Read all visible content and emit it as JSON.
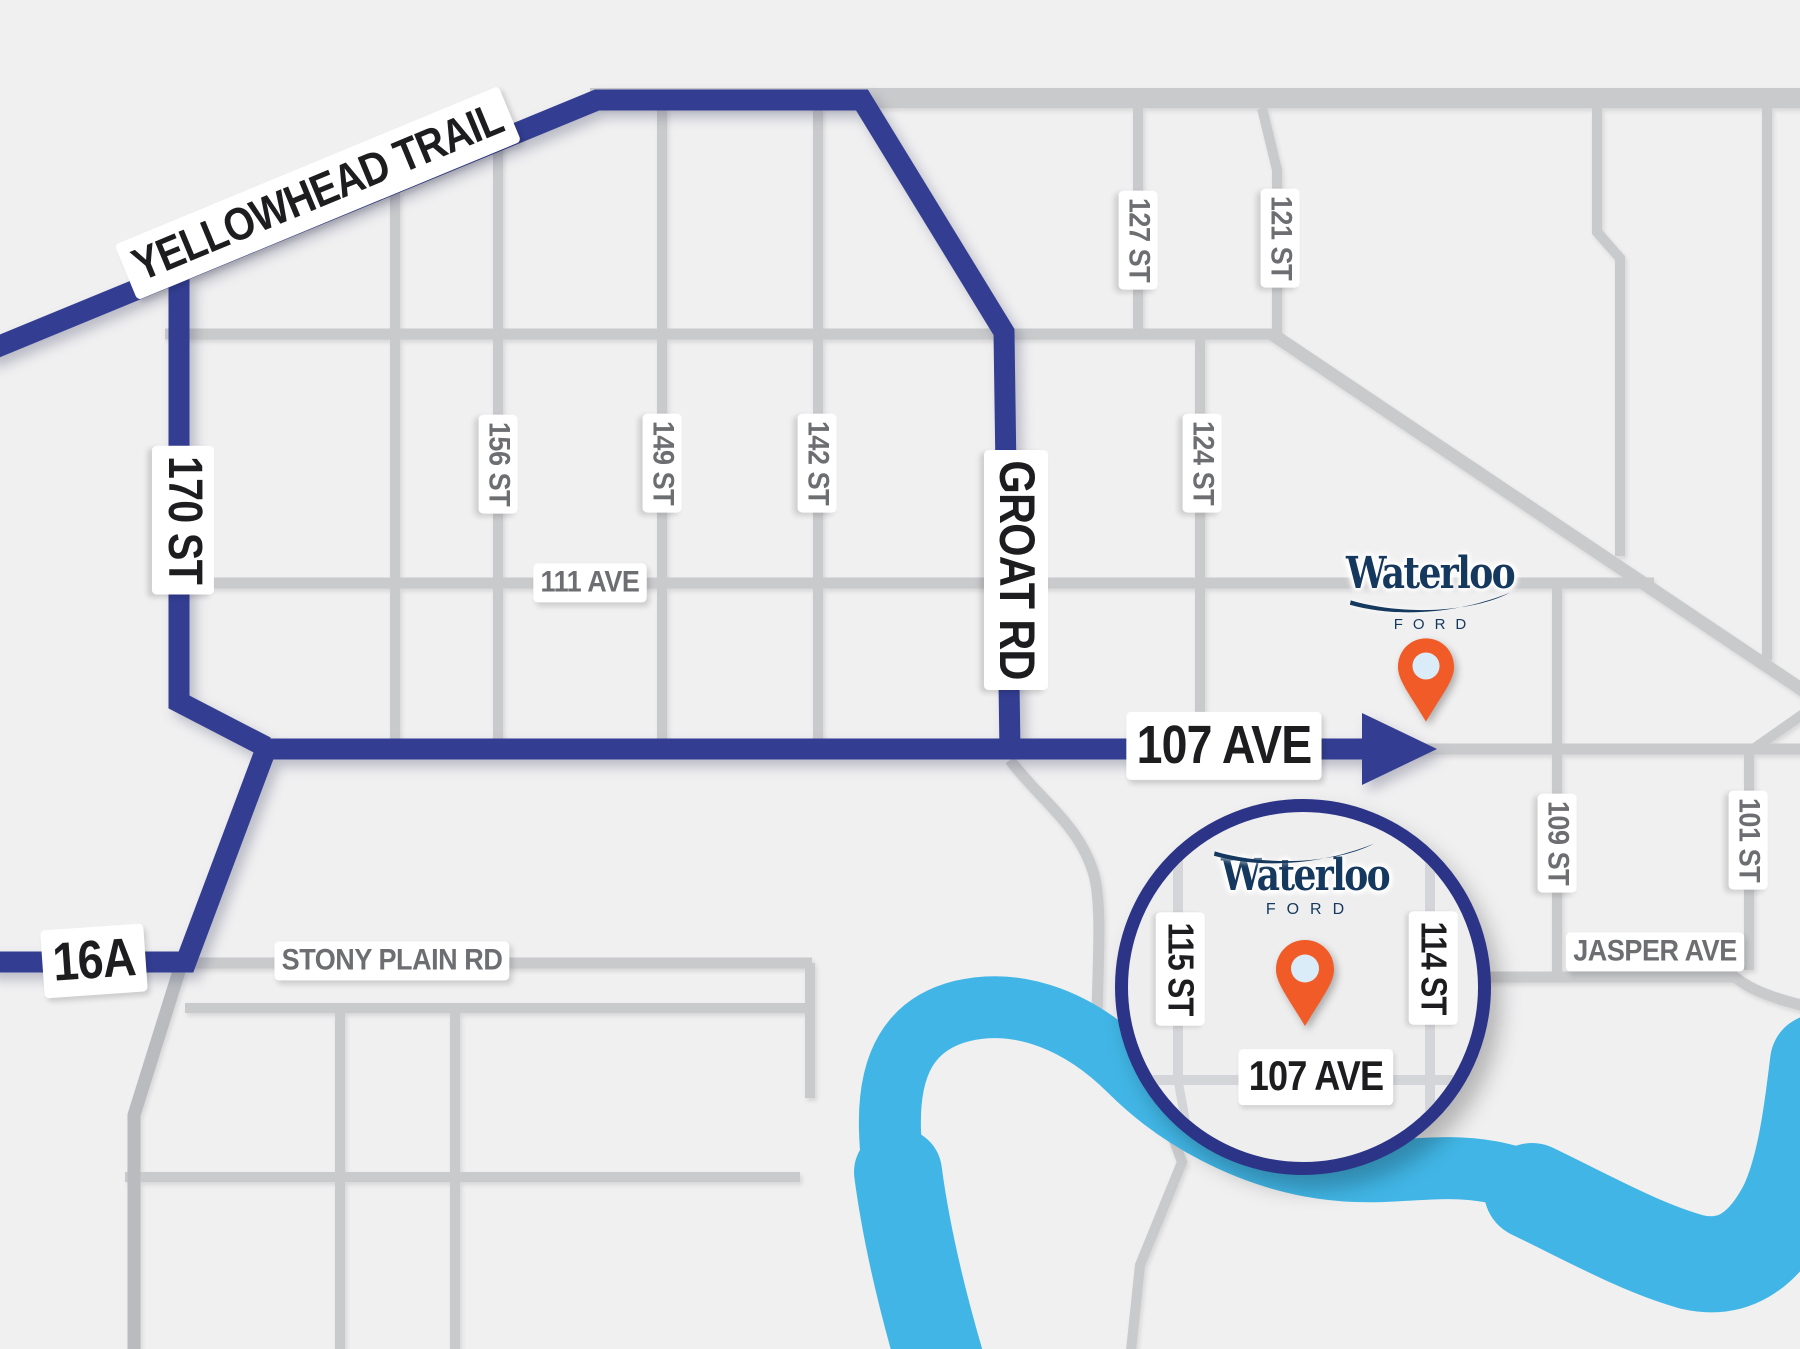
{
  "dealership": {
    "name": "Waterloo",
    "sub": "FORD"
  },
  "colors": {
    "background": "#f0f0f1",
    "inset_bg": "#eeeeef",
    "route": "#333e93",
    "ring": "#2c3487",
    "river": "#41b6e6",
    "road": "#c9cacc",
    "road_dark": "#b9bbbf",
    "inset_road": "#d4d5d8",
    "brand_navy": "#15395e",
    "pin_orange": "#f15b27",
    "pin_inner": "#d9ecf7",
    "label_black": "#1d1d20",
    "label_gray": "#6d6e71"
  },
  "map": {
    "labels": [
      {
        "text": "YELLOWHEAD TRAIL",
        "kind": "route",
        "x": 318,
        "y": 193,
        "rot": -22.5,
        "size": 46
      },
      {
        "text": "170 ST",
        "kind": "route",
        "x": 183,
        "y": 520,
        "rot": 90,
        "size": 48
      },
      {
        "text": "GROAT RD",
        "kind": "route",
        "x": 1016,
        "y": 570,
        "rot": 90,
        "size": 50
      },
      {
        "text": "107 AVE",
        "kind": "route",
        "x": 1224,
        "y": 746,
        "rot": 0,
        "size": 54
      },
      {
        "text": "16A",
        "kind": "route",
        "x": 94,
        "y": 961,
        "rot": -4,
        "size": 54
      },
      {
        "text": "156 ST",
        "kind": "street",
        "x": 498,
        "y": 464,
        "rot": 90,
        "size": 30
      },
      {
        "text": "149 ST",
        "kind": "street",
        "x": 662,
        "y": 463,
        "rot": 90,
        "size": 30
      },
      {
        "text": "142 ST",
        "kind": "street",
        "x": 817,
        "y": 463,
        "rot": 90,
        "size": 30
      },
      {
        "text": "111 AVE",
        "kind": "street",
        "x": 590,
        "y": 583,
        "rot": 0,
        "size": 30
      },
      {
        "text": "127 ST",
        "kind": "street",
        "x": 1138,
        "y": 240,
        "rot": 90,
        "size": 30
      },
      {
        "text": "121 ST",
        "kind": "street",
        "x": 1280,
        "y": 238,
        "rot": 90,
        "size": 30
      },
      {
        "text": "124 ST",
        "kind": "street",
        "x": 1202,
        "y": 463,
        "rot": 90,
        "size": 30
      },
      {
        "text": "STONY PLAIN RD",
        "kind": "street",
        "x": 392,
        "y": 961,
        "rot": 0,
        "size": 30
      },
      {
        "text": "JASPER AVE",
        "kind": "street",
        "x": 1655,
        "y": 952,
        "rot": 0,
        "size": 30
      },
      {
        "text": "109 ST",
        "kind": "street",
        "x": 1557,
        "y": 843,
        "rot": 90,
        "size": 30
      },
      {
        "text": "101 ST",
        "kind": "street",
        "x": 1748,
        "y": 840,
        "rot": 90,
        "size": 30
      }
    ],
    "inset": {
      "labels": [
        {
          "text": "115 ST",
          "x": 52,
          "y": 157,
          "rot": 90,
          "size": 36
        },
        {
          "text": "114 ST",
          "x": 305,
          "y": 156,
          "rot": 90,
          "size": 36
        },
        {
          "text": "107 AVE",
          "x": 188,
          "y": 265,
          "rot": 0,
          "size": 42
        }
      ]
    }
  }
}
